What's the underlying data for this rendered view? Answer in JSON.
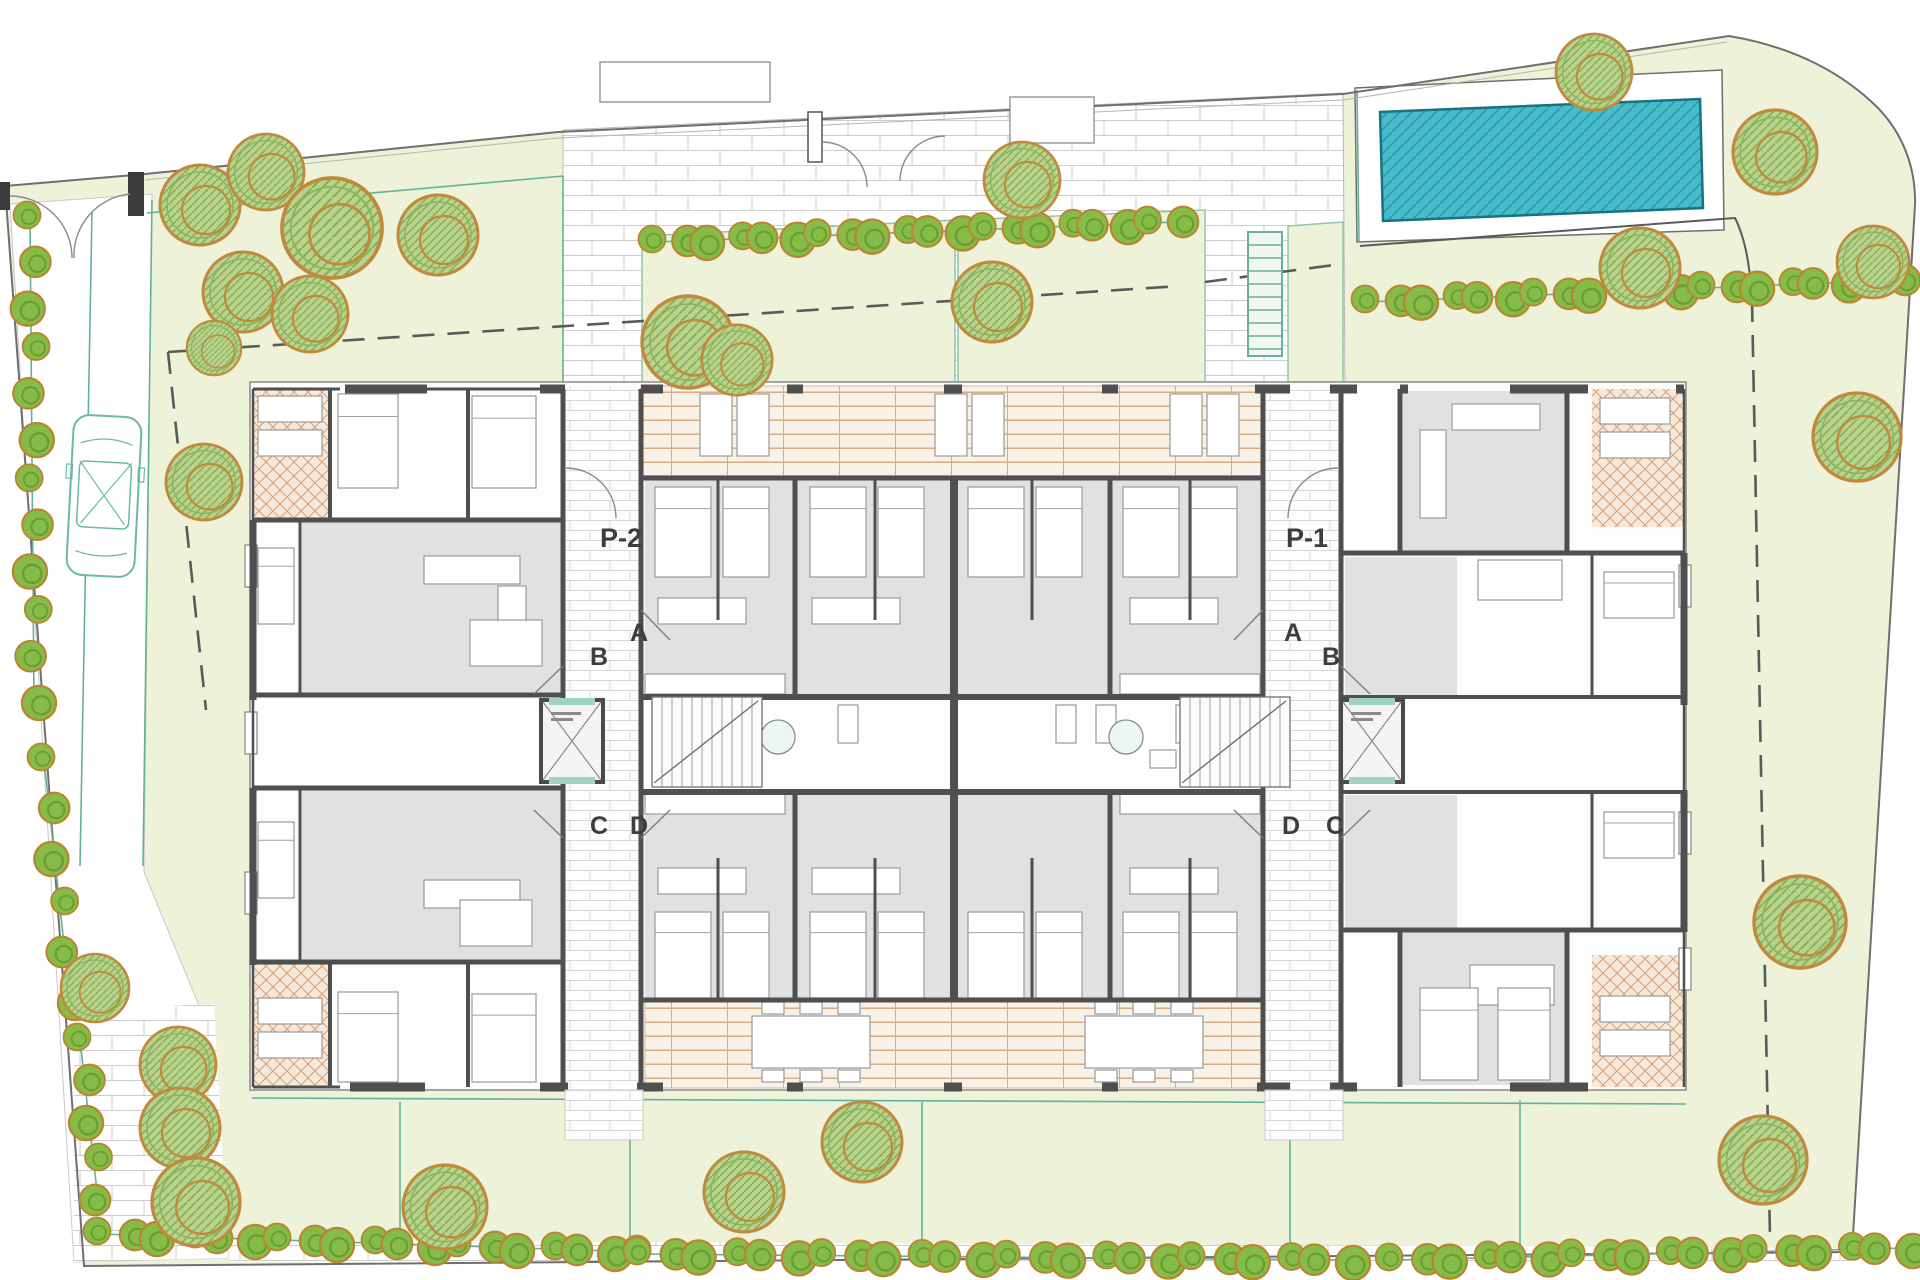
{
  "labels": {
    "portal_left": "P-2",
    "portal_right": "P-1",
    "door_a": "A",
    "door_b": "B",
    "door_c": "C",
    "door_d": "D"
  },
  "palette": {
    "lawn": "#edf2d8",
    "paving_joint": "#cdcdcd",
    "building_wall": "#4f4f4f",
    "room_floor_gray": "#e1e1e1",
    "terrace_grid_orange": "#d9ad82",
    "corner_terrace_hatch": "#d7a075",
    "pool_water": "#49bccb",
    "pool_hatch": "#2e9fae",
    "tree_green": "#b9d290",
    "tree_ring_orange": "#c08a3e",
    "bush_green": "#85bb47",
    "garden_line_teal": "#63b297",
    "site_boundary": "#6f6f6f",
    "label_text": "#3d3d3d"
  }
}
